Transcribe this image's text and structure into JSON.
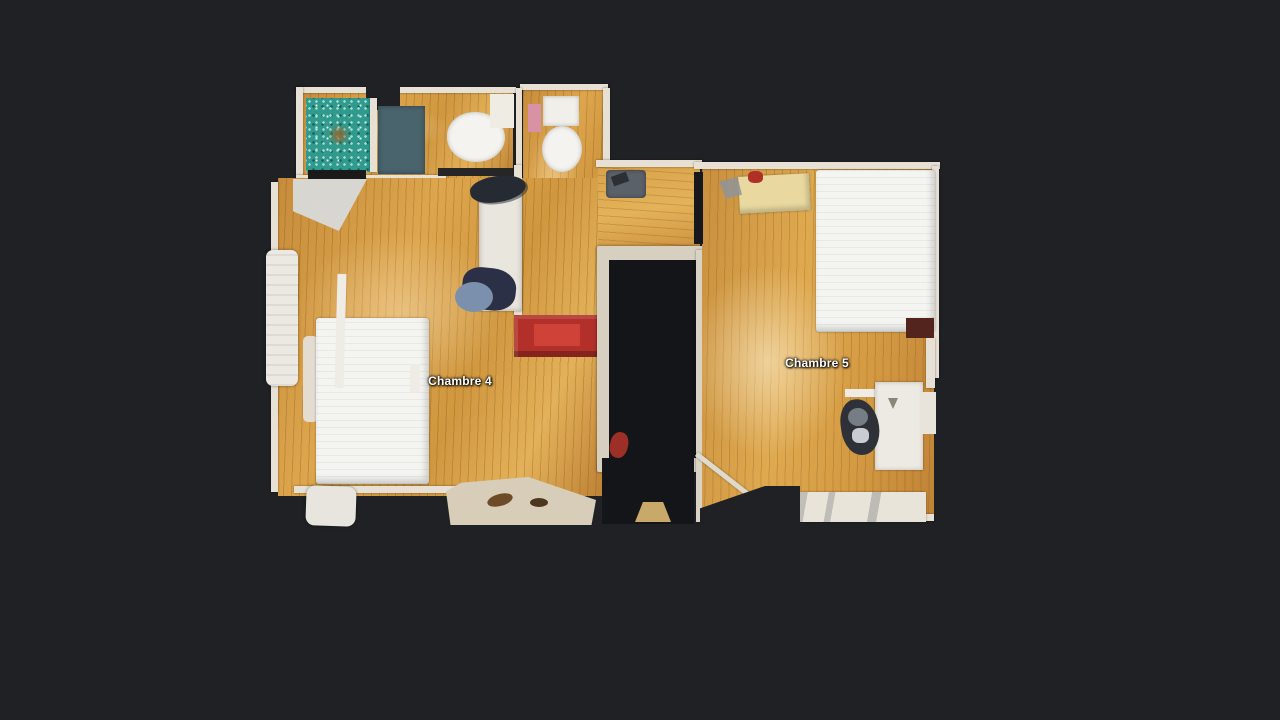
{
  "app": {
    "name": "3d-dollhouse-floorplan-view",
    "background_color": "#1f2125"
  },
  "floorplan": {
    "floor_labels": [
      {
        "id": "chambre-4",
        "label": "Chambre 4"
      },
      {
        "id": "chambre-5",
        "label": "Chambre 5"
      }
    ],
    "label_text_color": "#ffffff",
    "colors": {
      "background": "#1f2125",
      "wood_floor": "#cf9642",
      "wood_floor_hall": "#d9a64f",
      "wall_white": "#e7e1d5",
      "stair_frame": "#d7d0c0",
      "stair_opening": "#141519",
      "shower_mosaic_teal": "#2f9a8d",
      "bath_mat_slate": "#4a646e",
      "bath_rug_gray": "#6e7270",
      "mattress_white": "#f4f4f1",
      "red_chest": "#b23029",
      "blue_chair_seat": "#7b90ad",
      "blue_chair_back": "#2b3046",
      "yellow_bench": "#e9d9a0",
      "desk_white": "#edeae3",
      "office_chair_dark": "#2e3138"
    }
  }
}
